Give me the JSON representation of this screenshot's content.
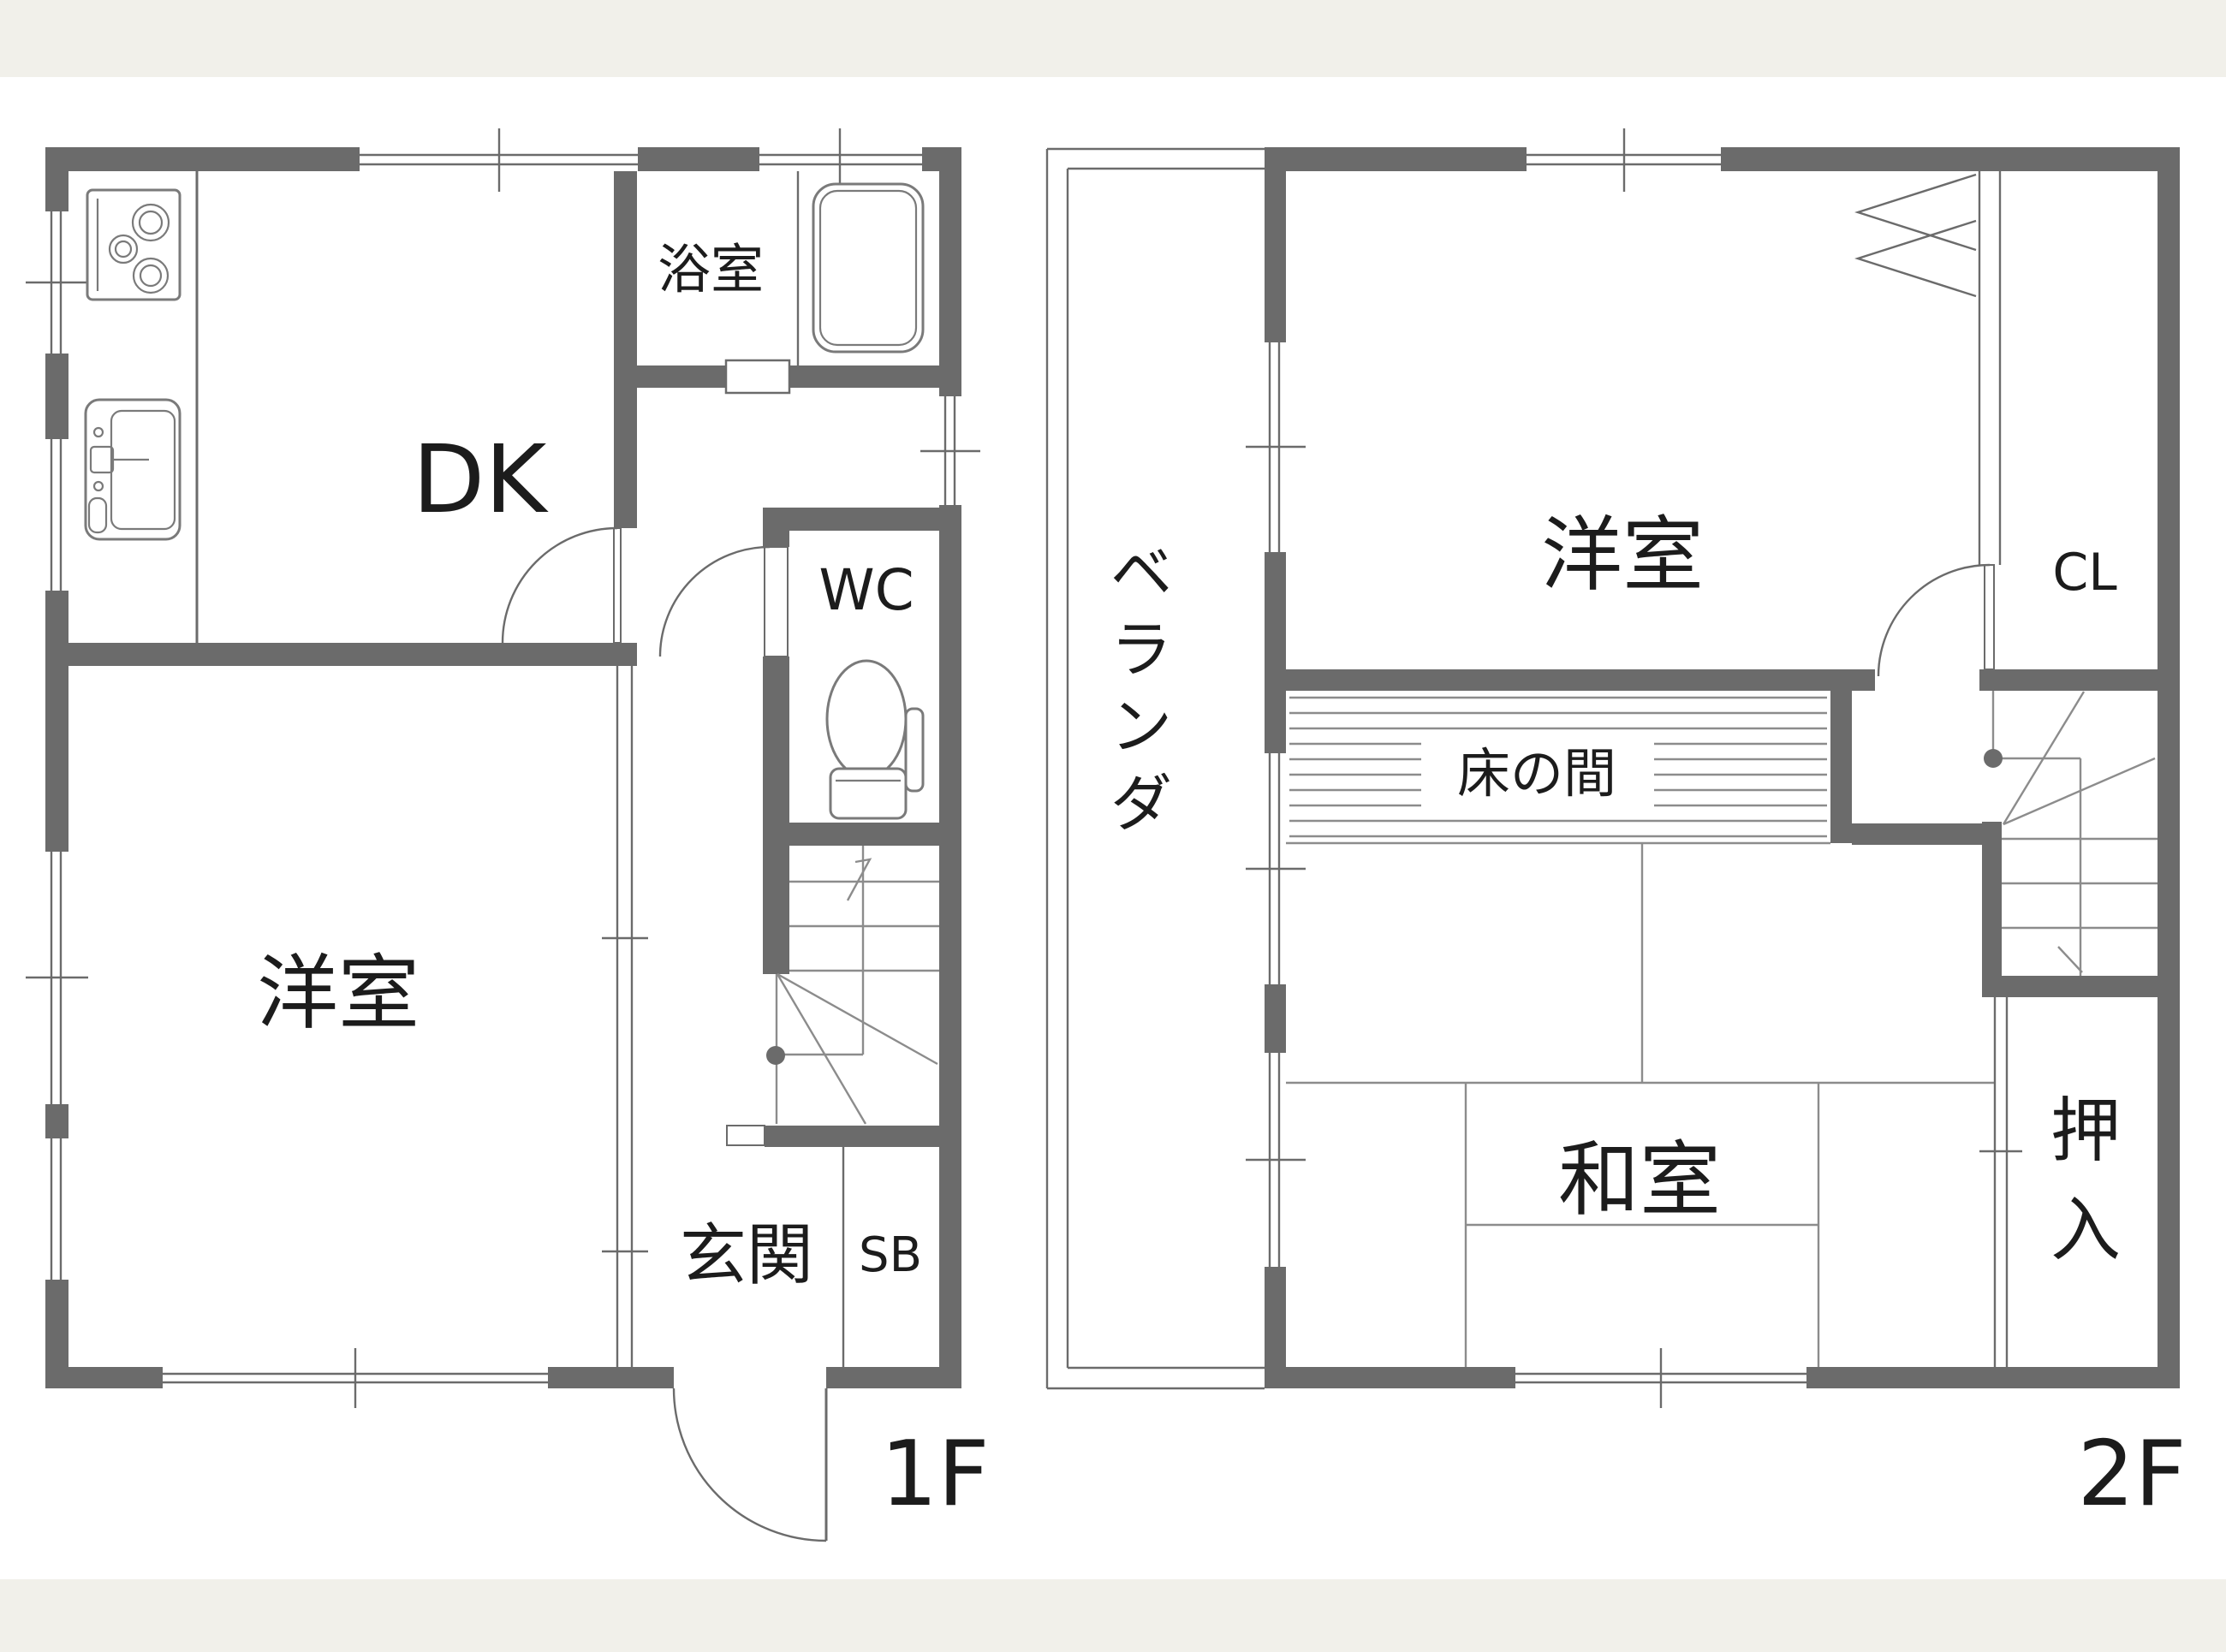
{
  "colors": {
    "background_band": "#f1f0ea",
    "canvas": "#ffffff",
    "wall": "#6b6b6b",
    "thin_line": "#7a7a7a",
    "text": "#1c1c1c"
  },
  "floor1": {
    "floor_label": "1F",
    "dk": "DK",
    "bath": "浴室",
    "wc": "WC",
    "west_room": "洋室",
    "entrance": "玄関",
    "shoebox": "SB"
  },
  "floor2": {
    "floor_label": "2F",
    "west_room": "洋室",
    "closet": "CL",
    "tokonoma": "床の間",
    "japanese_room": "和室",
    "veranda_chars": [
      "ベ",
      "ラ",
      "ン",
      "ダ"
    ],
    "oshiire_chars": [
      "押",
      "入"
    ]
  }
}
